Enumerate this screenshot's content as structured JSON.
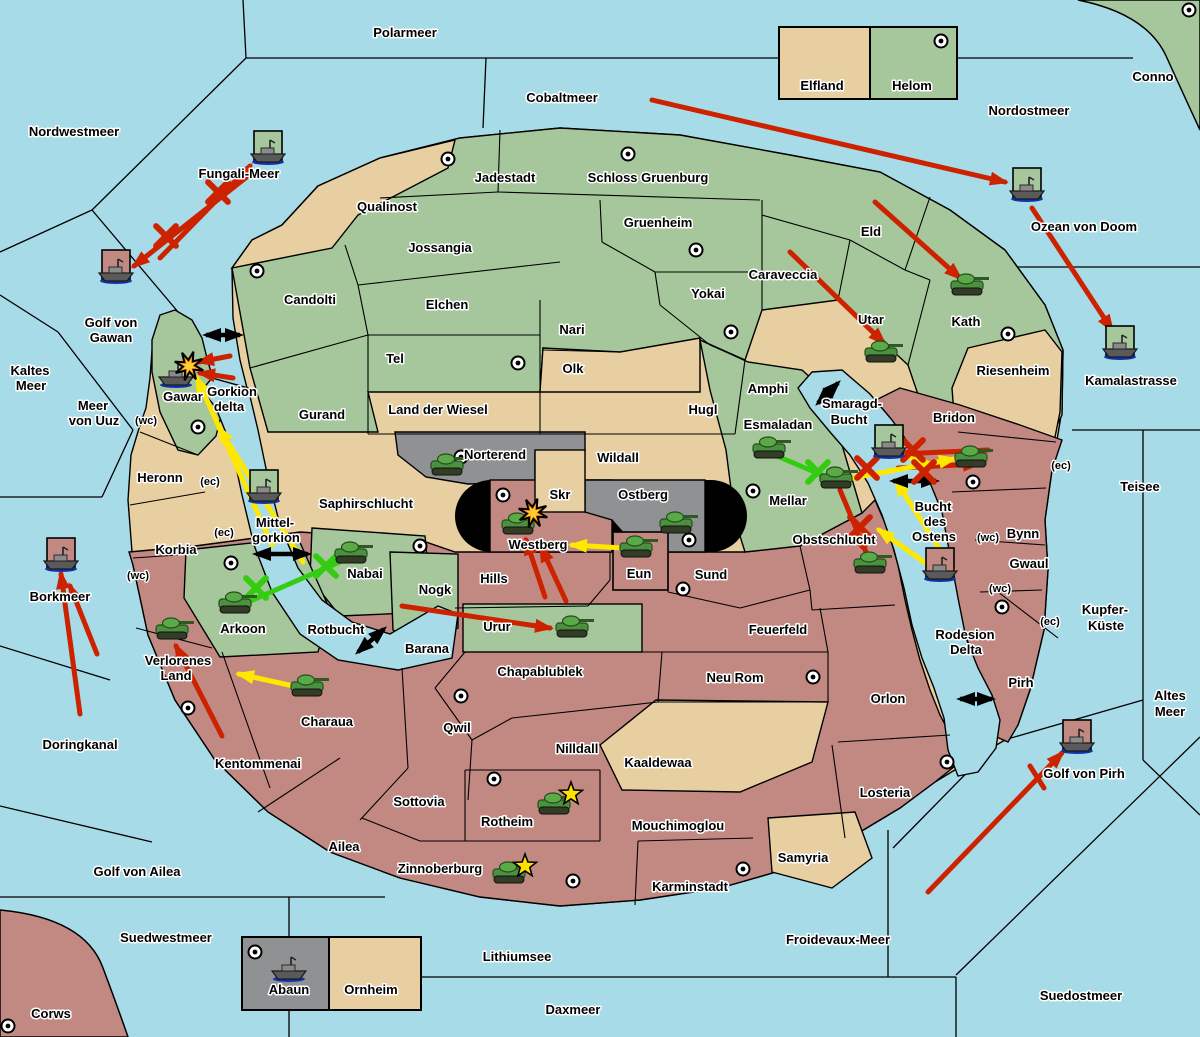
{
  "map_title": "Game map",
  "colors": {
    "sea": "#a8dbe8",
    "land_green": "#a6c79c",
    "land_tan": "#e7cfa2",
    "land_red": "#c28983",
    "land_gray": "#8f9193",
    "border": "#000000",
    "attack_red": "#cc2200",
    "support_yellow": "#ffe800",
    "support_green": "#33cc11",
    "strait_black": "#000000",
    "explosion_orange": "#ff8800",
    "build_star_yellow": "#ffe000"
  },
  "labels": {
    "sea": [
      {
        "text": "Polarmeer",
        "x": 405,
        "y": 33
      },
      {
        "text": "Cobaltmeer",
        "x": 562,
        "y": 98
      },
      {
        "text": "Nordostmeer",
        "x": 1029,
        "y": 111
      },
      {
        "text": "Nordwestmeer",
        "x": 74,
        "y": 132
      },
      {
        "text": "Fungali-Meer",
        "x": 239,
        "y": 174
      },
      {
        "text": "Ozean von Doom",
        "x": 1084,
        "y": 227
      },
      {
        "text": "Kamalastrasse",
        "x": 1131,
        "y": 381
      },
      {
        "text": "Kaltes",
        "x": 30,
        "y": 371
      },
      {
        "text": "Meer",
        "x": 31,
        "y": 386
      },
      {
        "text": "Golf von",
        "x": 111,
        "y": 323
      },
      {
        "text": "Gawan",
        "x": 111,
        "y": 338
      },
      {
        "text": "Meer",
        "x": 93,
        "y": 406
      },
      {
        "text": "von Uuz",
        "x": 94,
        "y": 421
      },
      {
        "text": "Gorkion",
        "x": 232,
        "y": 392
      },
      {
        "text": "delta",
        "x": 229,
        "y": 407
      },
      {
        "text": "Mittel-",
        "x": 275,
        "y": 523
      },
      {
        "text": "gorkion",
        "x": 276,
        "y": 538
      },
      {
        "text": "Borkmeer",
        "x": 60,
        "y": 597
      },
      {
        "text": "Smaragd-",
        "x": 852,
        "y": 404
      },
      {
        "text": "Bucht",
        "x": 849,
        "y": 420
      },
      {
        "text": "Bucht",
        "x": 933,
        "y": 507
      },
      {
        "text": "des",
        "x": 935,
        "y": 522
      },
      {
        "text": "Ostens",
        "x": 934,
        "y": 537
      },
      {
        "text": "Teisee",
        "x": 1140,
        "y": 487
      },
      {
        "text": "Kupfer-",
        "x": 1105,
        "y": 610
      },
      {
        "text": "Küste",
        "x": 1106,
        "y": 626
      },
      {
        "text": "Altes",
        "x": 1170,
        "y": 696
      },
      {
        "text": "Meer",
        "x": 1170,
        "y": 712
      },
      {
        "text": "Rodesion",
        "x": 965,
        "y": 635
      },
      {
        "text": "Delta",
        "x": 966,
        "y": 650
      },
      {
        "text": "Rotbucht",
        "x": 336,
        "y": 630
      },
      {
        "text": "Doringkanal",
        "x": 80,
        "y": 745
      },
      {
        "text": "Golf von Pirh",
        "x": 1084,
        "y": 774
      },
      {
        "text": "Golf von Ailea",
        "x": 137,
        "y": 872
      },
      {
        "text": "Suedwestmeer",
        "x": 166,
        "y": 938
      },
      {
        "text": "Lithiumsee",
        "x": 517,
        "y": 957
      },
      {
        "text": "Daxmeer",
        "x": 573,
        "y": 1010
      },
      {
        "text": "Froidevaux-Meer",
        "x": 838,
        "y": 940
      },
      {
        "text": "Suedostmeer",
        "x": 1081,
        "y": 996
      }
    ],
    "land": [
      {
        "text": "Jadestadt",
        "x": 505,
        "y": 178
      },
      {
        "text": "Schloss Gruenburg",
        "x": 648,
        "y": 178
      },
      {
        "text": "Gruenheim",
        "x": 658,
        "y": 223
      },
      {
        "text": "Yokai",
        "x": 708,
        "y": 294
      },
      {
        "text": "Caraveccia",
        "x": 783,
        "y": 275
      },
      {
        "text": "Eld",
        "x": 871,
        "y": 232
      },
      {
        "text": "Utar",
        "x": 871,
        "y": 320
      },
      {
        "text": "Kath",
        "x": 966,
        "y": 322
      },
      {
        "text": "Riesenheim",
        "x": 1013,
        "y": 371
      },
      {
        "text": "Qualinost",
        "x": 387,
        "y": 207
      },
      {
        "text": "Jossangia",
        "x": 440,
        "y": 248
      },
      {
        "text": "Elchen",
        "x": 447,
        "y": 305
      },
      {
        "text": "Nari",
        "x": 572,
        "y": 330
      },
      {
        "text": "Tel",
        "x": 395,
        "y": 359
      },
      {
        "text": "Olk",
        "x": 573,
        "y": 369
      },
      {
        "text": "Candolti",
        "x": 310,
        "y": 300
      },
      {
        "text": "Gurand",
        "x": 322,
        "y": 415
      },
      {
        "text": "Land der Wiesel",
        "x": 438,
        "y": 410
      },
      {
        "text": "Hugl",
        "x": 703,
        "y": 410
      },
      {
        "text": "Amphi",
        "x": 768,
        "y": 389
      },
      {
        "text": "Esmaladan",
        "x": 778,
        "y": 425
      },
      {
        "text": "Mellar",
        "x": 788,
        "y": 501
      },
      {
        "text": "Gawar",
        "x": 183,
        "y": 397
      },
      {
        "text": "Heronn",
        "x": 160,
        "y": 478
      },
      {
        "text": "Korbia",
        "x": 176,
        "y": 550
      },
      {
        "text": "Saphirschlucht",
        "x": 366,
        "y": 504
      },
      {
        "text": "Nabai",
        "x": 365,
        "y": 574
      },
      {
        "text": "Arkoon",
        "x": 243,
        "y": 629
      },
      {
        "text": "Nogk",
        "x": 435,
        "y": 590
      },
      {
        "text": "Urur",
        "x": 497,
        "y": 627
      },
      {
        "text": "Hills",
        "x": 494,
        "y": 579
      },
      {
        "text": "Westberg",
        "x": 538,
        "y": 545
      },
      {
        "text": "Skr",
        "x": 560,
        "y": 495
      },
      {
        "text": "Ostberg",
        "x": 643,
        "y": 495
      },
      {
        "text": "Wildall",
        "x": 618,
        "y": 458
      },
      {
        "text": "Norterend",
        "x": 495,
        "y": 455
      },
      {
        "text": "Eun",
        "x": 639,
        "y": 574
      },
      {
        "text": "Sund",
        "x": 711,
        "y": 575
      },
      {
        "text": "Obstschlucht",
        "x": 834,
        "y": 540
      },
      {
        "text": "Bridon",
        "x": 954,
        "y": 418
      },
      {
        "text": "Bynn",
        "x": 1023,
        "y": 534
      },
      {
        "text": "Gwaul",
        "x": 1029,
        "y": 564
      },
      {
        "text": "Pirh",
        "x": 1021,
        "y": 683
      },
      {
        "text": "Feuerfeld",
        "x": 778,
        "y": 630
      },
      {
        "text": "Neu Rom",
        "x": 735,
        "y": 678
      },
      {
        "text": "Chapablublek",
        "x": 540,
        "y": 672
      },
      {
        "text": "Qwil",
        "x": 457,
        "y": 728
      },
      {
        "text": "Nilldall",
        "x": 577,
        "y": 749
      },
      {
        "text": "Kaaldewaa",
        "x": 658,
        "y": 763
      },
      {
        "text": "Sottovia",
        "x": 419,
        "y": 802
      },
      {
        "text": "Rotheim",
        "x": 507,
        "y": 822
      },
      {
        "text": "Mouchimoglou",
        "x": 678,
        "y": 826
      },
      {
        "text": "Karminstadt",
        "x": 690,
        "y": 887
      },
      {
        "text": "Samyria",
        "x": 803,
        "y": 858
      },
      {
        "text": "Zinnoberburg",
        "x": 440,
        "y": 869
      },
      {
        "text": "Ailea",
        "x": 344,
        "y": 847
      },
      {
        "text": "Kentommenai",
        "x": 258,
        "y": 764
      },
      {
        "text": "Charaua",
        "x": 327,
        "y": 722
      },
      {
        "text": "Verlorenes",
        "x": 178,
        "y": 661
      },
      {
        "text": "Land",
        "x": 176,
        "y": 676
      },
      {
        "text": "Losteria",
        "x": 885,
        "y": 793
      },
      {
        "text": "Orlon",
        "x": 888,
        "y": 699
      },
      {
        "text": "Barana",
        "x": 427,
        "y": 649
      },
      {
        "text": "Corws",
        "x": 51,
        "y": 1014
      },
      {
        "text": "Conno",
        "x": 1153,
        "y": 77
      },
      {
        "text": "Elfland",
        "x": 822,
        "y": 86
      },
      {
        "text": "Helom",
        "x": 912,
        "y": 86
      },
      {
        "text": "Abaun",
        "x": 289,
        "y": 990
      },
      {
        "text": "Ornheim",
        "x": 371,
        "y": 990
      }
    ],
    "coast": [
      {
        "text": "(wc)",
        "x": 146,
        "y": 420
      },
      {
        "text": "(ec)",
        "x": 210,
        "y": 481
      },
      {
        "text": "(ec)",
        "x": 224,
        "y": 532
      },
      {
        "text": "(wc)",
        "x": 138,
        "y": 575
      },
      {
        "text": "(ec)",
        "x": 1061,
        "y": 465
      },
      {
        "text": "(wc)",
        "x": 988,
        "y": 537
      },
      {
        "text": "(wc)",
        "x": 1000,
        "y": 588
      },
      {
        "text": "(ec)",
        "x": 1050,
        "y": 621
      }
    ]
  },
  "supply_centers": [
    [
      448,
      159
    ],
    [
      628,
      154
    ],
    [
      941,
      41
    ],
    [
      1189,
      10
    ],
    [
      696,
      250
    ],
    [
      518,
      363
    ],
    [
      731,
      332
    ],
    [
      257,
      271
    ],
    [
      198,
      427
    ],
    [
      231,
      563
    ],
    [
      188,
      708
    ],
    [
      461,
      457
    ],
    [
      503,
      495
    ],
    [
      689,
      540
    ],
    [
      753,
      491
    ],
    [
      683,
      589
    ],
    [
      420,
      546
    ],
    [
      973,
      482
    ],
    [
      1002,
      607
    ],
    [
      461,
      696
    ],
    [
      813,
      677
    ],
    [
      947,
      762
    ],
    [
      494,
      779
    ],
    [
      573,
      881
    ],
    [
      743,
      869
    ],
    [
      8,
      1026
    ],
    [
      255,
      952
    ],
    [
      1008,
      334
    ]
  ],
  "units": {
    "tanks": [
      {
        "region": "Norterend",
        "x": 448,
        "y": 468
      },
      {
        "region": "Westberg",
        "x": 519,
        "y": 527
      },
      {
        "region": "Ostberg",
        "x": 677,
        "y": 526
      },
      {
        "region": "Eun",
        "x": 637,
        "y": 550
      },
      {
        "region": "Esmaladan",
        "x": 770,
        "y": 451
      },
      {
        "region": "Mellar",
        "x": 837,
        "y": 481
      },
      {
        "region": "Bridon",
        "x": 972,
        "y": 460
      },
      {
        "region": "Obstschlucht",
        "x": 871,
        "y": 566
      },
      {
        "region": "Utar",
        "x": 882,
        "y": 355
      },
      {
        "region": "Kath",
        "x": 968,
        "y": 288
      },
      {
        "region": "Nabai",
        "x": 352,
        "y": 556
      },
      {
        "region": "Arkoon",
        "x": 236,
        "y": 606
      },
      {
        "region": "Verlorenes Land",
        "x": 173,
        "y": 632
      },
      {
        "region": "Charaua",
        "x": 308,
        "y": 689
      },
      {
        "region": "Urur",
        "x": 573,
        "y": 630
      },
      {
        "region": "Rotheim",
        "x": 555,
        "y": 807
      },
      {
        "region": "Zinnoberburg",
        "x": 510,
        "y": 876
      }
    ],
    "ships": [
      {
        "region": "Fungali-Meer",
        "x": 268,
        "y": 153,
        "box": "green"
      },
      {
        "region": "Golf von Gawan",
        "x": 116,
        "y": 272,
        "box": "red"
      },
      {
        "region": "Gawar",
        "x": 176,
        "y": 376,
        "box": "none"
      },
      {
        "region": "Mittel-gorkion",
        "x": 264,
        "y": 492,
        "box": "green"
      },
      {
        "region": "Borkmeer",
        "x": 61,
        "y": 560,
        "box": "red"
      },
      {
        "region": "Bucht des Ostens",
        "x": 889,
        "y": 447,
        "box": "green"
      },
      {
        "region": "Bucht des Ostens",
        "x": 940,
        "y": 570,
        "box": "red"
      },
      {
        "region": "Ozean von Doom",
        "x": 1027,
        "y": 190,
        "box": "green"
      },
      {
        "region": "Kamalastrasse",
        "x": 1120,
        "y": 348,
        "box": "green"
      },
      {
        "region": "Golf von Pirh",
        "x": 1077,
        "y": 742,
        "box": "red"
      },
      {
        "region": "Abaun",
        "x": 289,
        "y": 970,
        "box": "none"
      }
    ]
  },
  "markers": {
    "explosions": [
      [
        189,
        366
      ],
      [
        533,
        513
      ]
    ],
    "build_stars": [
      [
        571,
        794
      ],
      [
        525,
        866
      ]
    ],
    "battle_x_red": [
      [
        218,
        192
      ],
      [
        166,
        236
      ],
      [
        913,
        450
      ],
      [
        924,
        472
      ],
      [
        867,
        468
      ],
      [
        860,
        527
      ]
    ],
    "battle_x_green": [
      [
        256,
        588
      ],
      [
        326,
        566
      ],
      [
        818,
        472
      ]
    ]
  },
  "orders": {
    "red_arrows": [
      [
        652,
        100,
        1005,
        182
      ],
      [
        875,
        202,
        960,
        278
      ],
      [
        1032,
        208,
        1112,
        330
      ],
      [
        790,
        252,
        884,
        343
      ],
      [
        160,
        258,
        250,
        166
      ],
      [
        253,
        172,
        134,
        266
      ],
      [
        230,
        356,
        199,
        362
      ],
      [
        233,
        378,
        200,
        373
      ],
      [
        545,
        597,
        526,
        540
      ],
      [
        566,
        601,
        541,
        547
      ],
      [
        402,
        606,
        550,
        628
      ],
      [
        222,
        736,
        176,
        646
      ],
      [
        80,
        714,
        61,
        574
      ],
      [
        97,
        654,
        70,
        586
      ],
      [
        928,
        892,
        1062,
        753
      ],
      [
        988,
        450,
        900,
        454
      ],
      [
        898,
        468,
        978,
        464
      ],
      [
        840,
        490,
        866,
        552
      ]
    ],
    "red_lines": [
      [
        1030,
        766,
        1044,
        788
      ]
    ],
    "yellow_arrows": [
      [
        272,
        545,
        197,
        378
      ],
      [
        303,
        562,
        219,
        428
      ],
      [
        640,
        549,
        572,
        545
      ],
      [
        298,
        687,
        239,
        674
      ],
      [
        826,
        483,
        954,
        459
      ],
      [
        893,
        453,
        930,
        464
      ],
      [
        945,
        577,
        879,
        530
      ],
      [
        953,
        570,
        896,
        481
      ]
    ],
    "green_supports": [
      [
        239,
        606,
        351,
        557
      ],
      [
        770,
        453,
        838,
        482
      ]
    ],
    "strait_arrows": [
      [
        206,
        335,
        240,
        335
      ],
      [
        256,
        554,
        308,
        554
      ],
      [
        818,
        403,
        838,
        383
      ],
      [
        358,
        652,
        384,
        629
      ],
      [
        960,
        699,
        992,
        699
      ],
      [
        893,
        481,
        936,
        481
      ]
    ]
  }
}
